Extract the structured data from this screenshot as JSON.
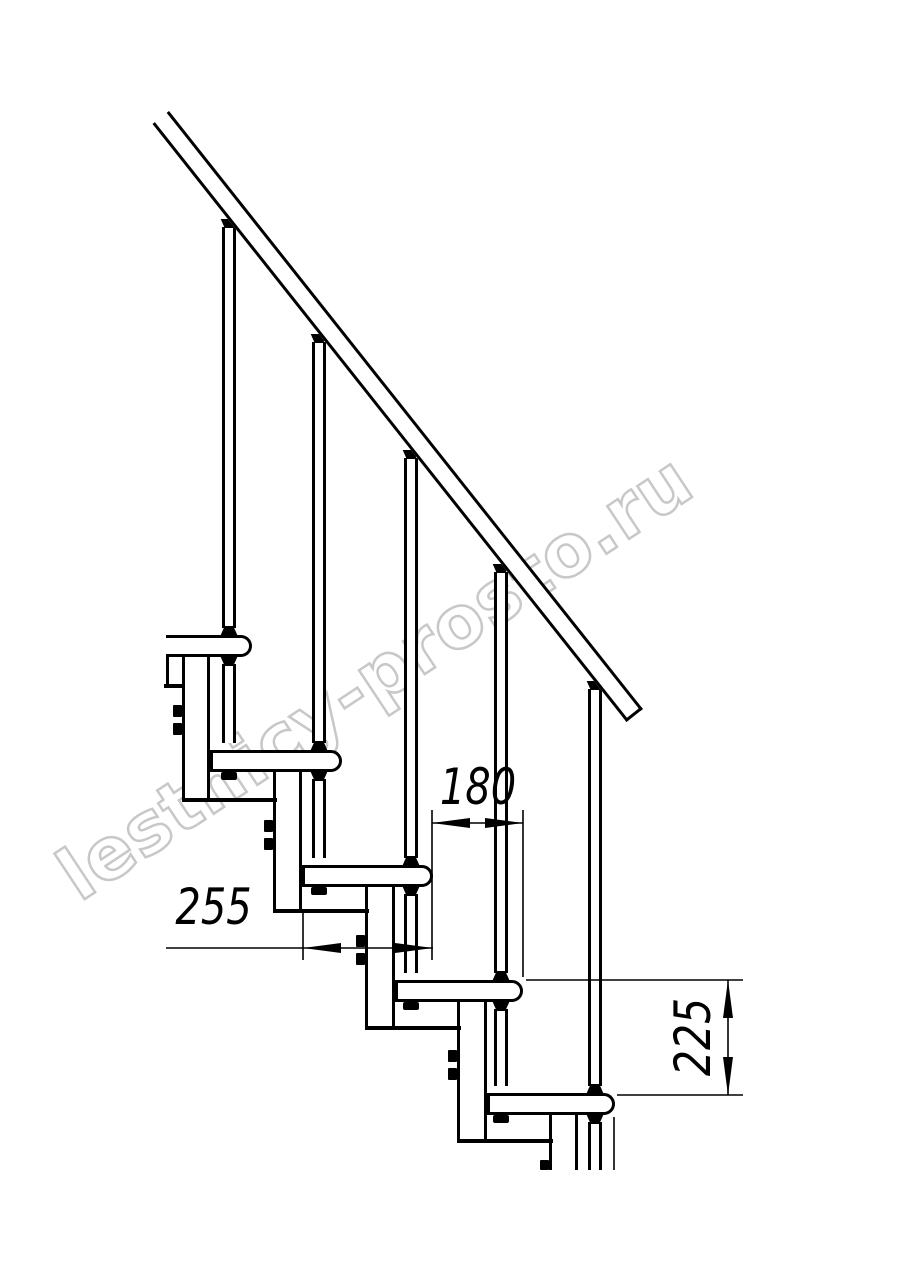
{
  "watermark": {
    "text": "lestnicy-prosto.ru",
    "color": "#c8c8c8"
  },
  "drawing": {
    "kind": "modular staircase side-view technical drawing",
    "background": "#ffffff",
    "line_color": "#000000"
  },
  "dimensions": [
    {
      "id": "step-run-offset",
      "value": "180",
      "orientation": "horizontal"
    },
    {
      "id": "tread-depth",
      "value": "255",
      "orientation": "horizontal"
    },
    {
      "id": "riser-height",
      "value": "225",
      "orientation": "vertical"
    }
  ]
}
